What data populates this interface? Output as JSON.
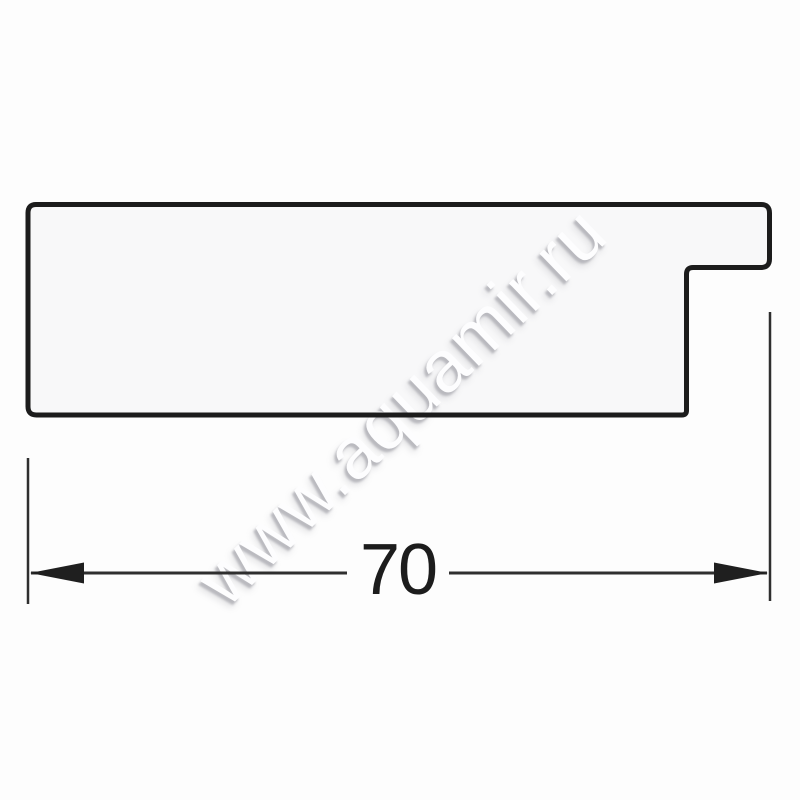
{
  "title": "Frame profile cross-section drawing",
  "drawing": {
    "shape": "mirror-frame-profile-cross-section",
    "fill_color": "#f8f8f9",
    "outline_color": "#1c1c1c"
  },
  "dimension": {
    "value": "70",
    "line_color": "#2f2f2f",
    "arrow_color": "#1f1f1f"
  },
  "watermark": {
    "text": "www.aquamir.ru",
    "text_color": "#fdfdfe",
    "shadow_color": "#b0b0b6"
  }
}
